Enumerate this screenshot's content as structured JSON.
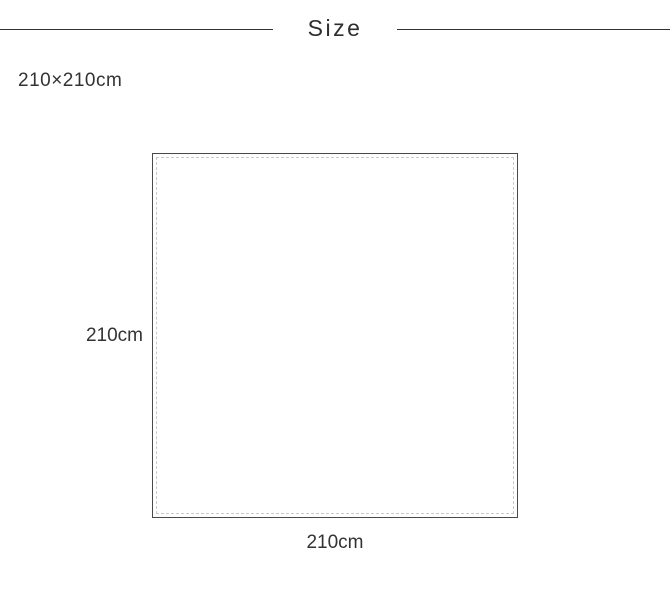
{
  "header": {
    "title": "Size"
  },
  "dimensions": {
    "full_size": "210×210cm",
    "height": "210cm",
    "width": "210cm"
  },
  "diagram": {
    "shape": "square",
    "border_style": "solid outer with inner dashed stitch line"
  },
  "colors": {
    "background": "#ffffff",
    "text": "#333333",
    "header_rule": "#333333",
    "square_border": "#4a4a4a",
    "stitch_line": "#c9c9c9"
  }
}
